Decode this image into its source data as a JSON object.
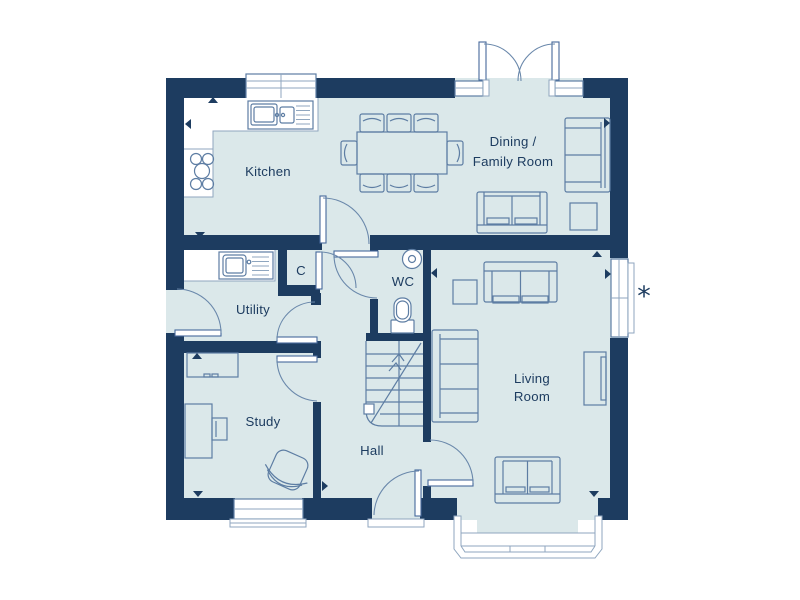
{
  "plan": {
    "type": "floor-plan",
    "rooms": {
      "kitchen": "Kitchen",
      "dining_line1": "Dining /",
      "dining_line2": "Family Room",
      "utility": "Utility",
      "cupboard": "C",
      "wc": "WC",
      "study": "Study",
      "hall": "Hall",
      "living_line1": "Living",
      "living_line2": "Room"
    },
    "annotations": {
      "window_note": "*"
    },
    "features": [
      "stairs-up",
      "french-doors",
      "bay-window",
      "front-door"
    ],
    "colors": {
      "wall": "#1d3c60",
      "floor": "#dbe8ea",
      "outline": "#5d7da3",
      "fixture": "#ffffff",
      "text": "#1d3c60"
    }
  }
}
